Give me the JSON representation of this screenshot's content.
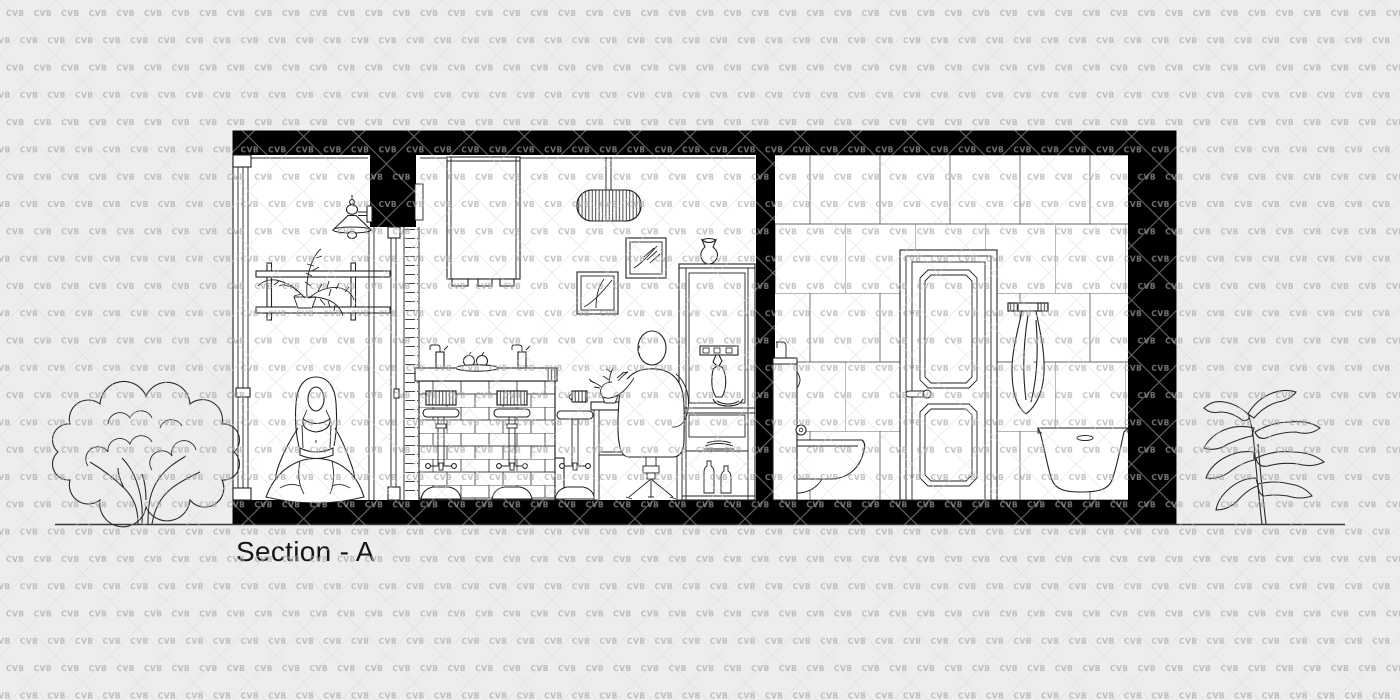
{
  "label": {
    "title": "Section - A"
  },
  "watermark": {
    "text": "CVB"
  },
  "palette": {
    "background": "#ededed",
    "paper": "#ffffff",
    "line": "#222222",
    "section_cut_fill": "#000000",
    "tile_line": "#666666",
    "watermark_gray": "#a8a8a8",
    "label_color": "#161616"
  },
  "scene": {
    "type": "architectural-section-elevation",
    "rooms": [
      {
        "name": "lounge",
        "objects": [
          "window-wall",
          "wall-lamp",
          "wall-shelf",
          "potted-fern",
          "meditating-woman",
          "glass-partition"
        ]
      },
      {
        "name": "kitchen-bar",
        "objects": [
          "hanging-cabinet",
          "pendant-lamp",
          "picture-frame-small",
          "picture-frame-large",
          "brick-bar-counter",
          "beer-tap",
          "beer-tap",
          "fruit-plate",
          "bar-stool",
          "bar-stool",
          "bar-stool",
          "round-table",
          "striped-mug",
          "table-plant",
          "seated-man",
          "tripod-stool",
          "shelving-unit",
          "vase",
          "hook-rail",
          "hanging-tie",
          "bowl",
          "drawer",
          "stacked-plates",
          "bottles"
        ]
      },
      {
        "name": "bathroom",
        "objects": [
          "tiled-wall",
          "paneled-door",
          "door-handle",
          "wall-hung-toilet",
          "flush-button",
          "towel-rail",
          "hanging-towel",
          "bathtub"
        ]
      }
    ],
    "exterior": [
      "deciduous-tree",
      "leafy-plant",
      "ground-line"
    ]
  }
}
